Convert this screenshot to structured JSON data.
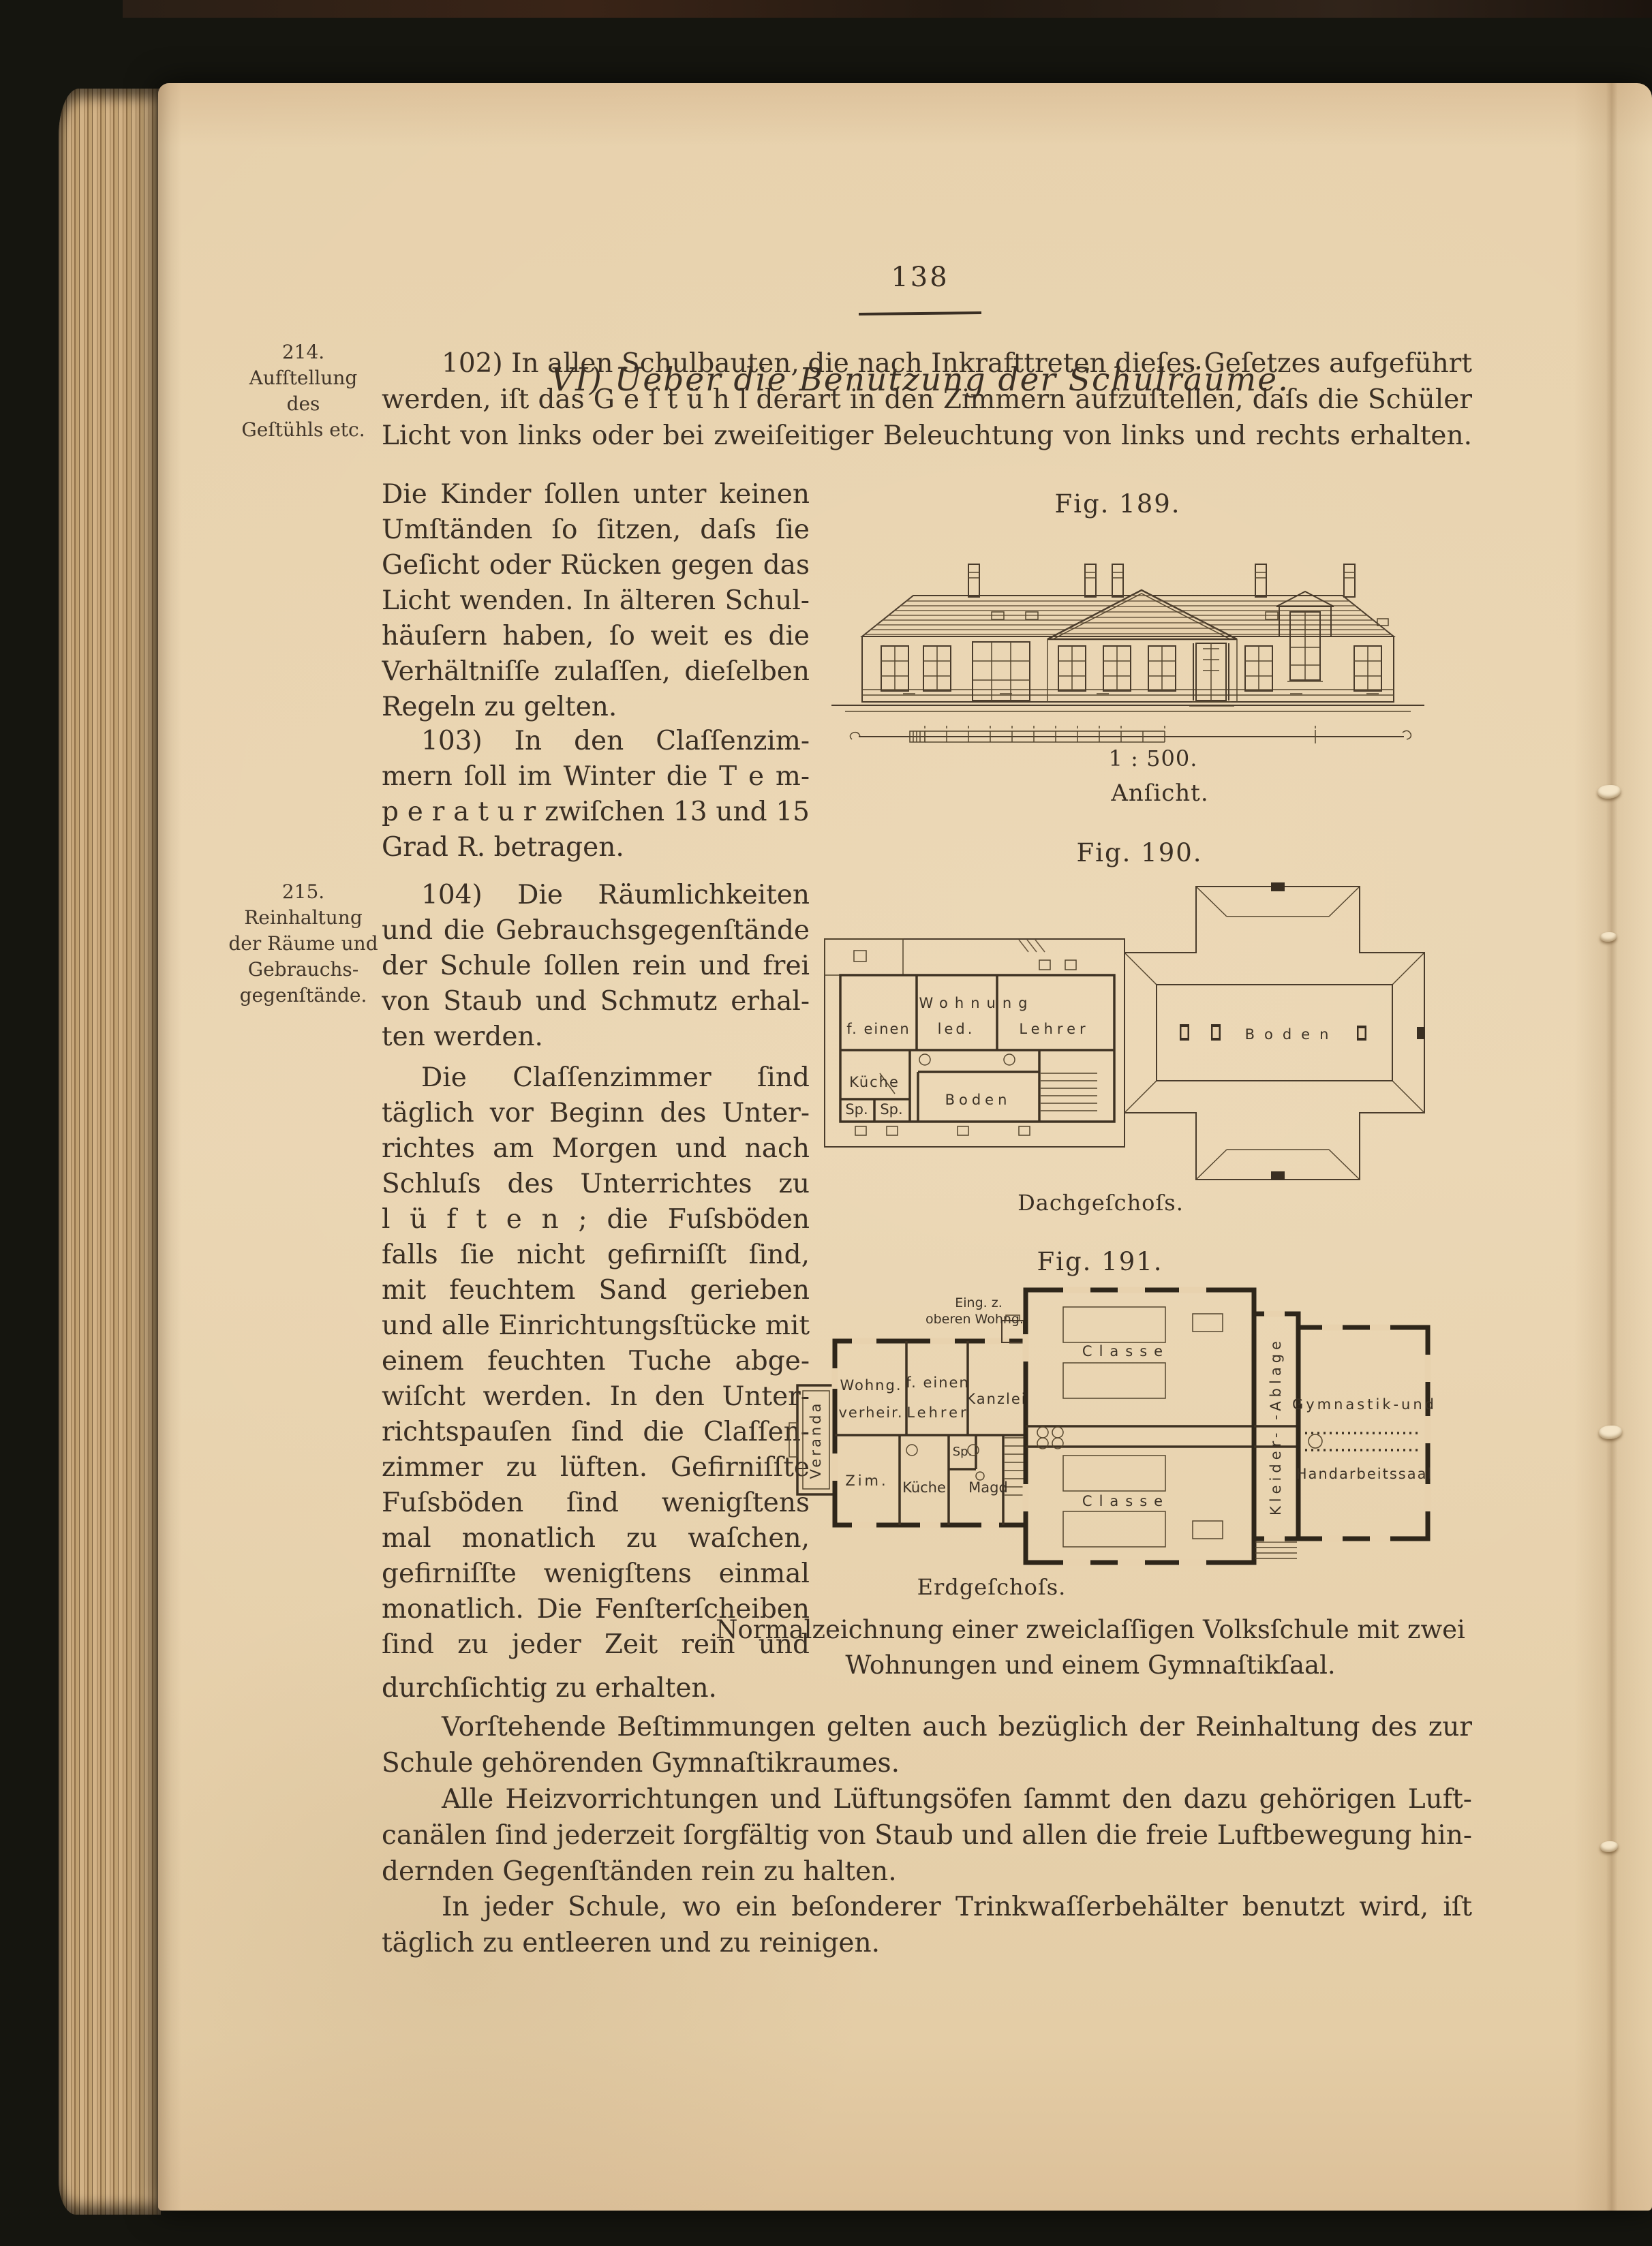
{
  "colors": {
    "paper": "#e8d2ae",
    "ink": "#3a2f24",
    "figure_line": "#4a3c2c",
    "background": "#15150f"
  },
  "page": {
    "number": "138",
    "heading": "VI) Ueber die Benutzung der Schulräume.",
    "margin_note_214": {
      "num": "214.",
      "lines": [
        "Aufſtellung",
        "des",
        "Geſtühls etc."
      ]
    },
    "margin_note_215": {
      "num": "215.",
      "lines": [
        "Reinhaltung",
        "der Räume und",
        "Gebrauchs-",
        "gegenſtände."
      ]
    },
    "para_102": [
      "102) In allen Schulbauten, die nach Inkrafttreten dieſes Geſetzes aufgeführt",
      "werden, iſt das G e ſ t ü h l derart in den Zimmern aufzuſtellen, daſs die Schüler das",
      "Licht von links oder bei zweiſeitiger Beleuchtung von links und rechts erhalten."
    ],
    "col_para_a": [
      "Die Kinder ſollen unter keinen",
      "Umſtänden ſo ſitzen, daſs ſie",
      "Geſicht oder Rücken gegen das",
      "Licht wenden. In älteren Schul-",
      "häuſern haben, ſo weit es die",
      "Verhältniſſe zulaſſen, dieſelben",
      "Regeln zu gelten."
    ],
    "col_para_103": [
      "103) In den Claſſenzim-",
      "mern ſoll im Winter die T e m-",
      "p e r a t u r zwiſchen 13 und 15",
      "Grad R. betragen."
    ],
    "col_para_104": [
      "104) Die Räumlichkeiten",
      "und die Gebrauchsgegenſtände",
      "der Schule ſollen rein und frei",
      "von Staub und Schmutz erhal-",
      "ten werden."
    ],
    "col_para_d": [
      "Die Claſſenzimmer ſind",
      "täglich vor Beginn des Unter-",
      "richtes am Morgen und nach",
      "Schluſs des Unterrichtes zu",
      "l ü f t e n ; die Fuſsböden ſollen,",
      "falls ſie nicht gefirniſſt ſind,",
      "mit feuchtem Sand gerieben",
      "und alle Einrichtungsſtücke mit",
      "einem feuchten Tuche abge-",
      "wiſcht werden. In den Unter-",
      "richtspauſen ſind die Claſſen-",
      "zimmer zu lüften. Gefirniſſte",
      "Fuſsböden ſind wenigſtens zwei-",
      "mal monatlich zu waſchen, nicht",
      "gefirniſſte wenigſtens einmal",
      "monatlich. Die Fenſterſcheiben",
      "ſind zu jeder Zeit rein und"
    ],
    "line_durchsichtig": "durchſichtig zu erhalten.",
    "para_vorstehende": [
      "Vorſtehende Beſtimmungen gelten auch bezüglich der Reinhaltung des zur",
      "Schule gehörenden Gymnaſtikraumes."
    ],
    "para_heiz": [
      "Alle Heizvorrichtungen und Lüftungsöfen ſammt den dazu gehörigen Luft-",
      "canälen ſind jederzeit ſorgfältig von Staub und allen die freie Luftbewegung hin-",
      "dernden Gegenſtänden rein zu halten."
    ],
    "para_trink": [
      "In jeder Schule, wo ein beſonderer Trinkwaſſerbehälter benutzt wird, iſt dieſer",
      "täglich zu entleeren und zu reinigen."
    ]
  },
  "figures": {
    "fig189": {
      "label": "Fig. 189.",
      "scale": "1 : 500.",
      "caption": "Anſicht."
    },
    "fig190": {
      "label": "Fig. 190.",
      "caption": "Dachgeſchoſs.",
      "rooms": {
        "wohnung": "Wohnung",
        "f_einen": "f. einen",
        "led": "led.",
        "lehrer": "Lehrer",
        "kueche": "Küche",
        "boden_left": "Boden",
        "sp1": "Sp.",
        "sp2": "Sp.",
        "boden_right": "Boden"
      }
    },
    "fig191": {
      "label": "Fig. 191.",
      "caption": "Erdgeſchoſs.",
      "caption_lines": [
        "Normalzeichnung einer zweiclaſſigen Volksſchule mit zwei",
        "Wohnungen und einem Gymnaſtikſaal."
      ],
      "rooms": {
        "eing1": "Eing. z.",
        "eing2": "oberen Wohng.",
        "wohng": "Wohng.",
        "verheir": "verheir.",
        "f_einen": "f. einen",
        "lehrer": "Lehrer",
        "kanzlei": "Kanzlei",
        "veranda": "Veranda",
        "zim": "Zim.",
        "kueche": "Küche",
        "sp": "Sp.",
        "magd": "Magd",
        "classe_a": "Classe",
        "classe_b": "Classe",
        "kleider": "Kleider- -Ablage",
        "gym1": "Gymnastik-und",
        "gym2": "Handarbeitssaal"
      }
    }
  }
}
